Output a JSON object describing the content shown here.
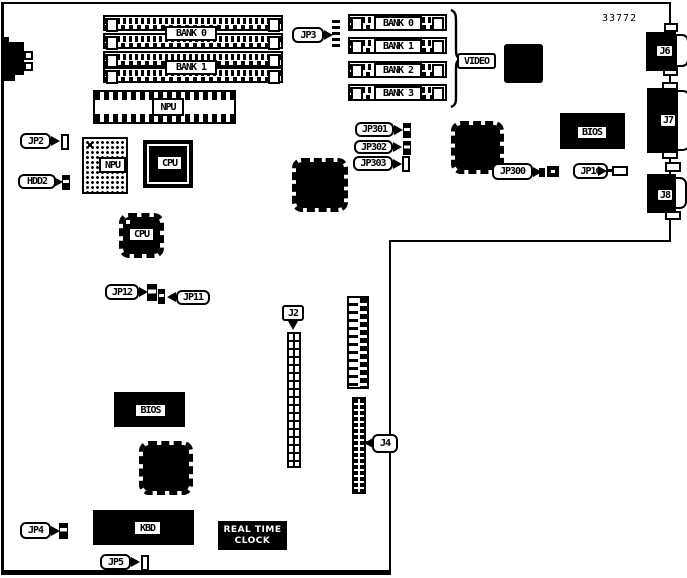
{
  "diagram": {
    "part_number": "33772",
    "left_banks": [
      "BANK 0",
      "BANK 1"
    ],
    "right_banks": [
      "BANK 0",
      "BANK 1",
      "BANK 2",
      "BANK 3"
    ],
    "chips": {
      "npu_socket": "NPU",
      "npu": "NPU",
      "cpu_main": "CPU",
      "cpu_secondary": "CPU",
      "video": "VIDEO",
      "bios_top": "BIOS",
      "bios_bottom": "BIOS",
      "kbd": "KBD",
      "rtc_line1": "REAL TIME",
      "rtc_line2": "CLOCK"
    },
    "jumpers": {
      "jp2": "JP2",
      "jp3": "JP3",
      "jp4": "JP4",
      "jp5": "JP5",
      "jp11": "JP11",
      "jp12": "JP12",
      "jp16": "JP16",
      "jp300": "JP300",
      "jp301": "JP301",
      "jp302": "JP302",
      "jp303": "JP303",
      "hdd2": "HDD2"
    },
    "connectors": {
      "j2": "J2",
      "j4": "J4",
      "j6": "J6",
      "j7": "J7",
      "j8": "J8"
    }
  }
}
